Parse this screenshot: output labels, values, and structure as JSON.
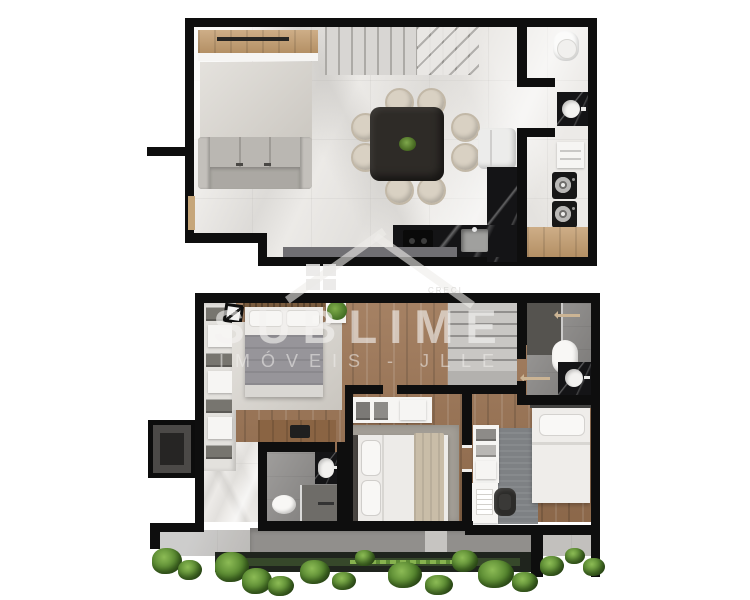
{
  "image_type": "top-down architectural floor plan render, two storeys of a duplex apartment",
  "watermark": {
    "brand": "SUBLIME",
    "subtitle": "IMÓVEIS - JLLE",
    "license": "CRECI",
    "color": "#f3f2f0",
    "logo": "house-outline-with-window-grid"
  },
  "palette": {
    "background": "#ffffff",
    "walls": "#0e0e0e",
    "marble_floor": "#eceae7",
    "wood_floor": "#9b7352",
    "wood_panel": "#c39c6d",
    "black_stone_counter": "#141416",
    "bathroom_tile": "#8a8886",
    "rug": "#d6d2cb",
    "sofa": "#b5b2ad",
    "dining_table": "#2e2b27",
    "chair": "#d9d1c3",
    "plant_green": "#4f7f2a",
    "terrace": "#b0adaa",
    "planter": "#1f241d"
  },
  "floors": {
    "upper": {
      "label": "Upper floor - living, dining, kitchen, bathroom, laundry",
      "rooms": [
        {
          "name": "living-room",
          "furniture": [
            "tv-wood-panel",
            "tv",
            "rug",
            "three-seat-sofa"
          ]
        },
        {
          "name": "dining-area",
          "furniture": [
            "square-dark-table",
            "8-round-chairs",
            "table-centerpiece-plant"
          ]
        },
        {
          "name": "kitchen",
          "furniture": [
            "l-shaped-black-stone-counter",
            "cooktop",
            "sink",
            "fridge"
          ]
        },
        {
          "name": "staircase",
          "furniture": [
            "straight-run-with-winders"
          ]
        },
        {
          "name": "bathroom",
          "furniture": [
            "toilet",
            "black-sink-counter"
          ]
        },
        {
          "name": "laundry",
          "furniture": [
            "cabinet",
            "washer",
            "dryer",
            "wood-bench"
          ]
        }
      ]
    },
    "lower": {
      "label": "Lower floor - bedrooms, bathrooms, terrace garden",
      "rooms": [
        {
          "name": "master-bedroom",
          "furniture": [
            "double-bed",
            "wardrobe-shelves",
            "rug",
            "wall-art",
            "plant-on-stand",
            "wood-desk",
            "laptop"
          ]
        },
        {
          "name": "bathroom-1",
          "furniture": [
            "toilet",
            "black-sink-counter",
            "shower"
          ]
        },
        {
          "name": "bedroom-2",
          "furniture": [
            "double-bed",
            "open-shelf",
            "rug"
          ]
        },
        {
          "name": "bathroom-2",
          "furniture": [
            "toilet",
            "black-sink-counter",
            "shower"
          ]
        },
        {
          "name": "bedroom-3",
          "furniture": [
            "single-bed",
            "shelf-unit",
            "desk",
            "office-chair",
            "rug"
          ]
        },
        {
          "name": "staircase",
          "furniture": []
        },
        {
          "name": "terrace",
          "furniture": [
            "stone-deck",
            "planter-box",
            "garden-plants"
          ]
        },
        {
          "name": "service-shaft",
          "furniture": []
        }
      ]
    }
  }
}
